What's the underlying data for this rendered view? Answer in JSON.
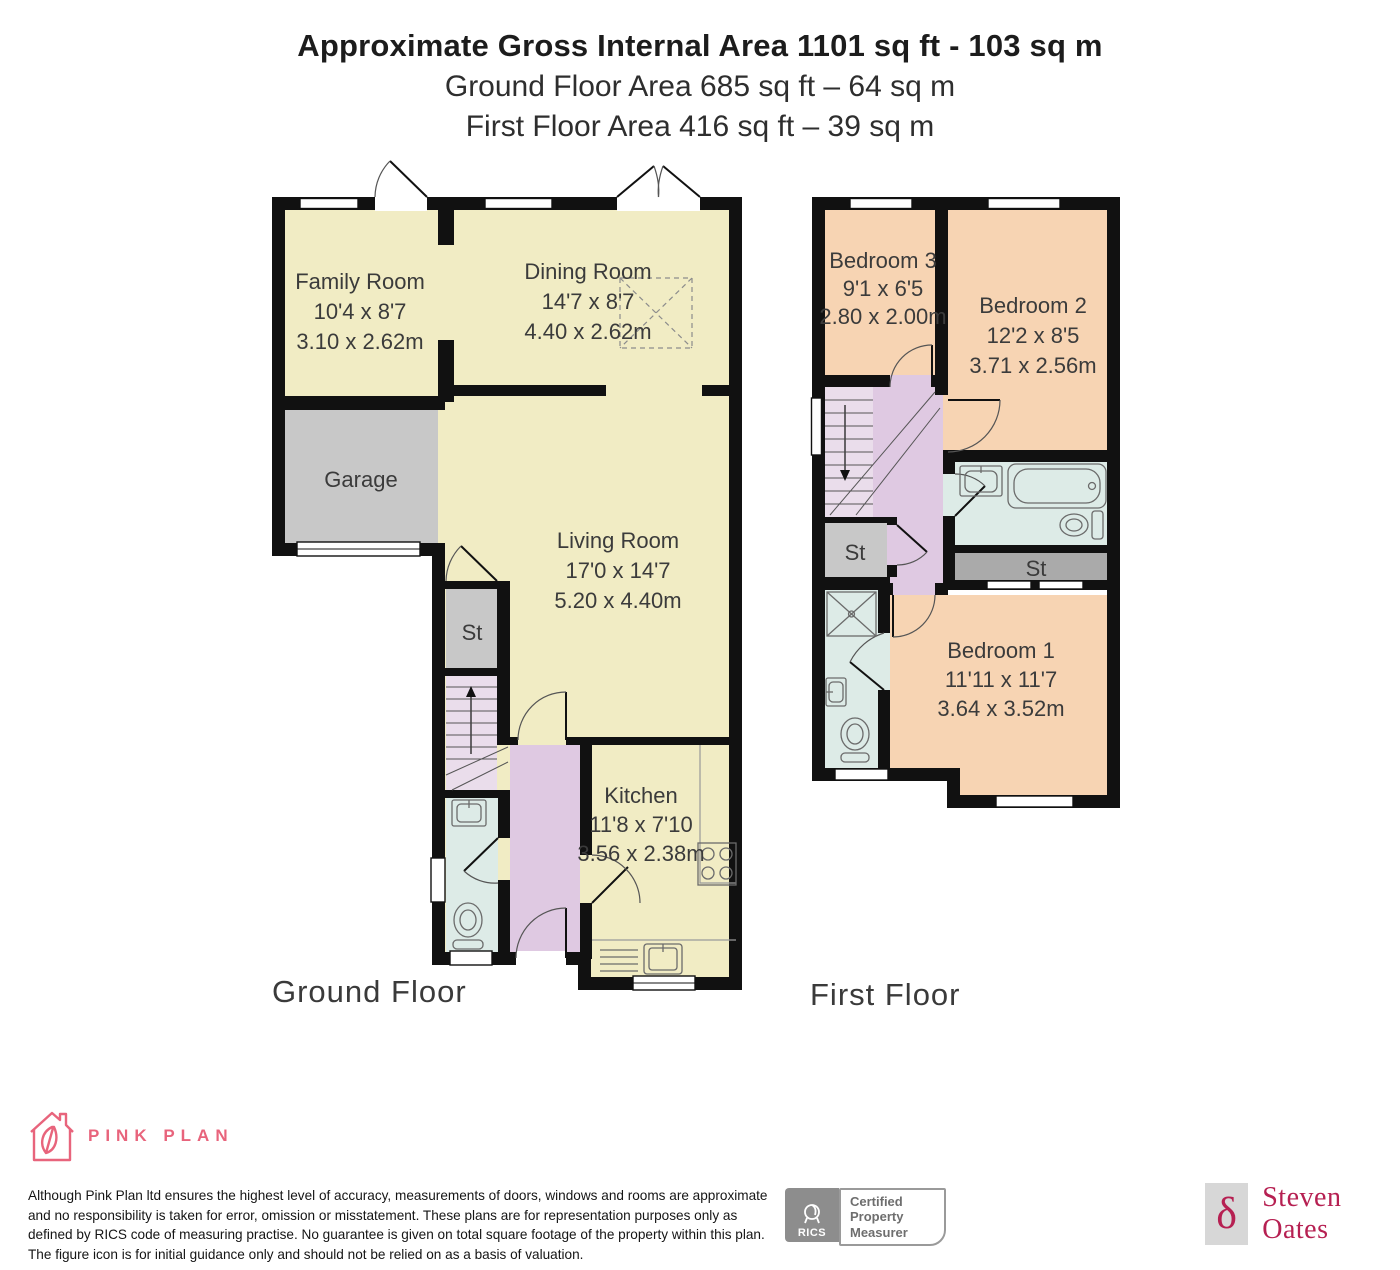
{
  "header": {
    "title": "Approximate Gross Internal Area 1101 sq ft - 103 sq m",
    "subtitle_ground": "Ground Floor Area 685 sq ft – 64 sq m",
    "subtitle_first": "First Floor Area 416 sq ft – 39 sq m"
  },
  "floors": {
    "ground": {
      "label": "Ground Floor",
      "rooms": {
        "family": {
          "name": "Family Room",
          "imperial": "10'4 x 8'7",
          "metric": "3.10 x 2.62m"
        },
        "dining": {
          "name": "Dining Room",
          "imperial": "14'7 x 8'7",
          "metric": "4.40 x 2.62m"
        },
        "garage": {
          "name": "Garage"
        },
        "living": {
          "name": "Living Room",
          "imperial": "17'0 x 14'7",
          "metric": "5.20 x 4.40m"
        },
        "store": {
          "name": "St"
        },
        "kitchen": {
          "name": "Kitchen",
          "imperial": "11'8 x 7'10",
          "metric": "3.56 x 2.38m"
        }
      }
    },
    "first": {
      "label": "First Floor",
      "rooms": {
        "bedroom3": {
          "name": "Bedroom 3",
          "imperial": "9'1 x 6'5",
          "metric": "2.80 x 2.00m"
        },
        "bedroom2": {
          "name": "Bedroom 2",
          "imperial": "12'2 x 8'5",
          "metric": "3.71 x 2.56m"
        },
        "bedroom1": {
          "name": "Bedroom 1",
          "imperial": "11'11 x 11'7",
          "metric": "3.64 x 3.52m"
        },
        "store_left": {
          "name": "St"
        },
        "store_right": {
          "name": "St"
        }
      }
    }
  },
  "footer": {
    "brand_name": "PINK PLAN",
    "disclaimer": "Although Pink Plan ltd ensures the highest level of accuracy, measurements of doors, windows and rooms are approximate and no responsibility is taken for error, omission or misstatement. These plans are for representation purposes only as defined by RICS code of measuring practise. No guarantee is given on total square footage of the property within this plan. The figure icon is for initial guidance only and should not be relied on as a basis of valuation.",
    "rics_label": "RICS",
    "certification": {
      "line1": "Certified",
      "line2": "Property",
      "line3": "Measurer"
    },
    "agent_name": "Steven Oates",
    "agent_mark": "δ"
  },
  "palette": {
    "wall": "#111111",
    "room_cream": "#F1ECC4",
    "room_peach": "#F7D4B3",
    "garage_gray": "#C8C8C8",
    "store_gray_dark": "#AAAAAA",
    "stair_lilac": "#EADDEB",
    "hall_lilac": "#DFC9E2",
    "bath_blue": "#DDEBE7",
    "brand_pink": "#E8647C",
    "agent_crimson": "#B62052"
  }
}
